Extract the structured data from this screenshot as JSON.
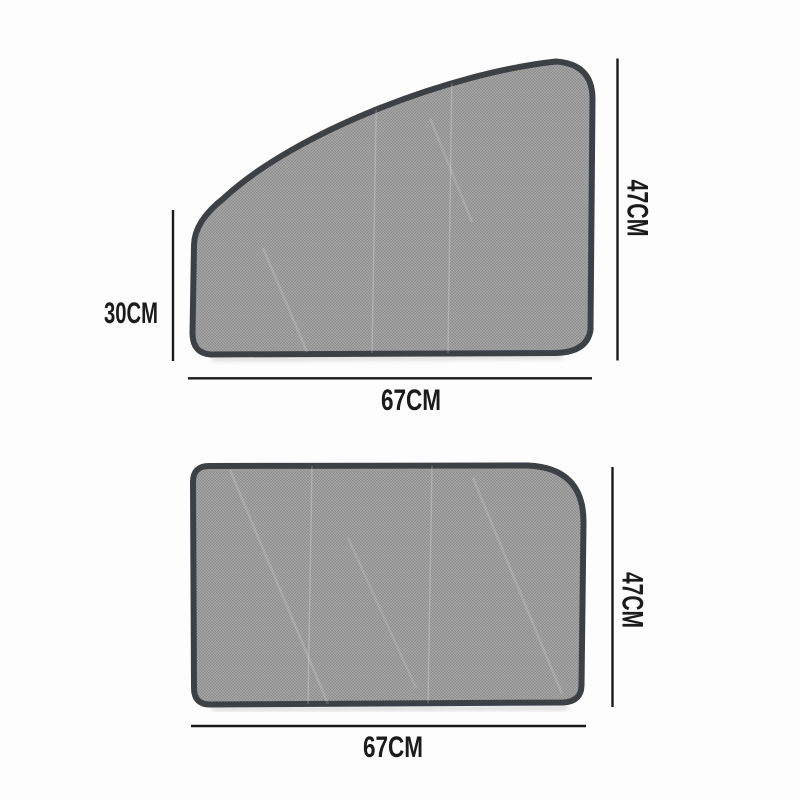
{
  "diagram": {
    "description": "Car side-window magnetic sunshade dimension diagram with two mesh panels",
    "front_shade": {
      "left_height": "30CM",
      "right_height": "47CM",
      "bottom_width": "67CM"
    },
    "rear_shade": {
      "right_height": "47CM",
      "bottom_width": "67CM"
    },
    "colors": {
      "background": "#fdfdfd",
      "mesh_base": "#9a9a9a",
      "mesh_light": "#a9a9a9",
      "mesh_dark": "#8c8c8c",
      "trim_border": "#3d4045",
      "dimension_line": "#1a1a1a",
      "label_text": "#1b1b1b"
    }
  }
}
